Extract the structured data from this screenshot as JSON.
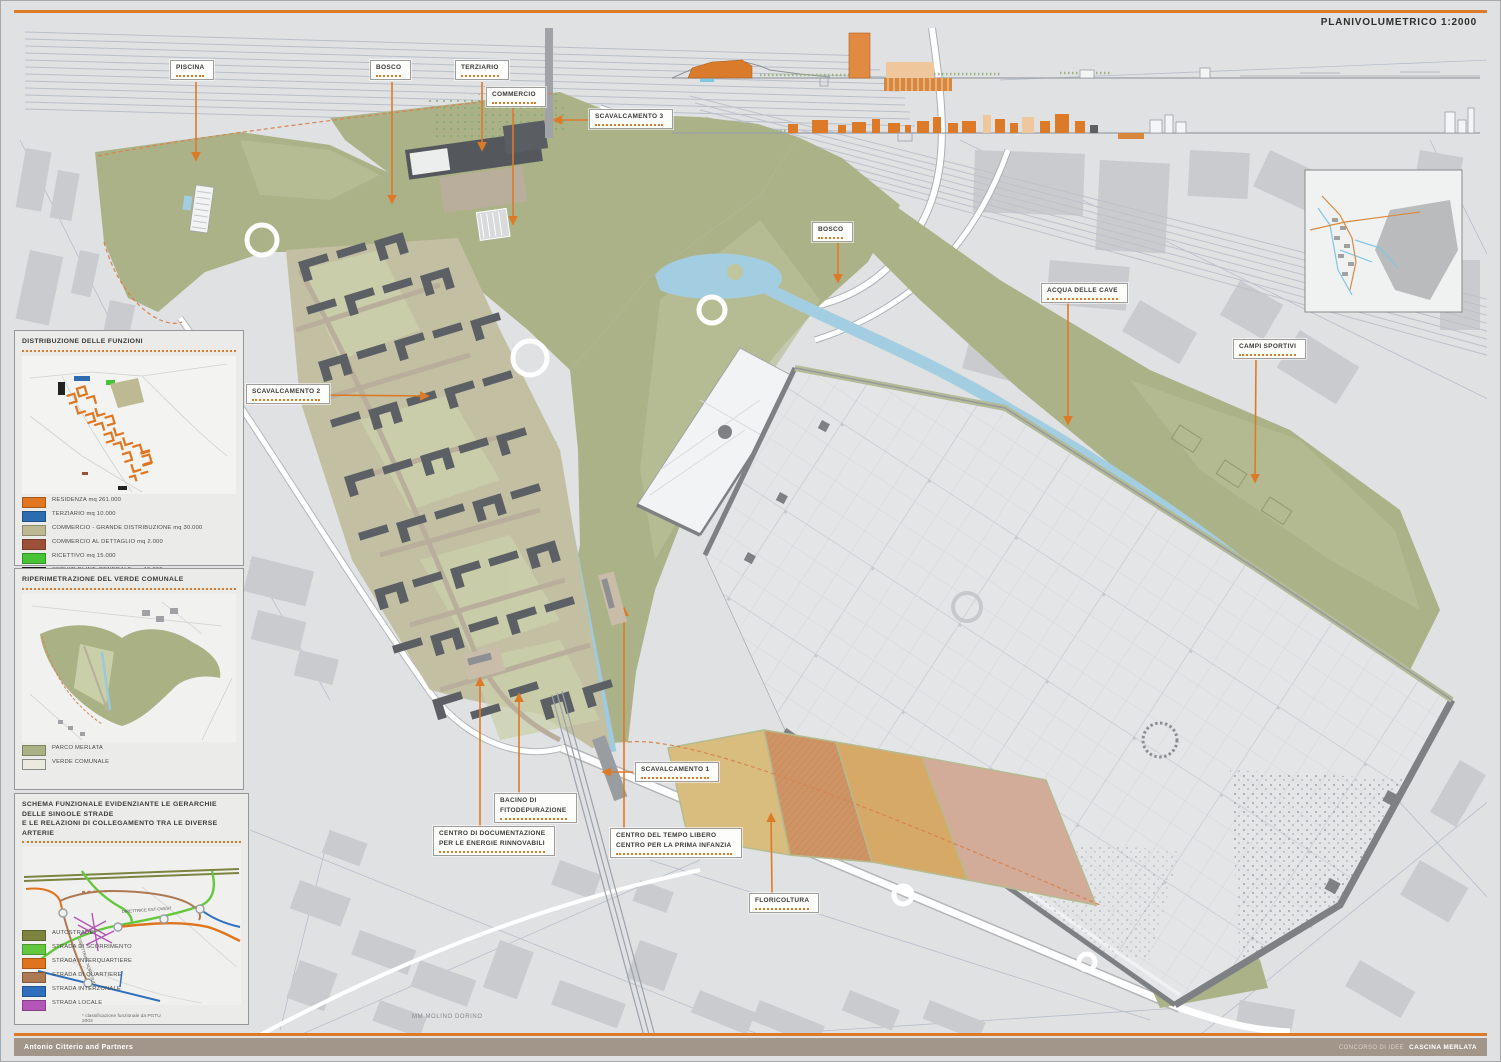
{
  "title": "PLANIVOLUMETRICO 1:2000",
  "accent_color": "#dd7a28",
  "map_labels": [
    {
      "id": "piscina",
      "lines": [
        "PISCINA"
      ]
    },
    {
      "id": "bosco-1",
      "lines": [
        "BOSCO"
      ]
    },
    {
      "id": "terziario",
      "lines": [
        "TERZIARIO"
      ]
    },
    {
      "id": "commercio",
      "lines": [
        "COMMERCIO"
      ]
    },
    {
      "id": "scavalcamento-3",
      "lines": [
        "SCAVALCAMENTO 3"
      ]
    },
    {
      "id": "bosco-2",
      "lines": [
        "BOSCO"
      ]
    },
    {
      "id": "acqua-delle-cave",
      "lines": [
        "ACQUA DELLE CAVE"
      ]
    },
    {
      "id": "campi-sportivi",
      "lines": [
        "CAMPI SPORTIVI"
      ]
    },
    {
      "id": "scavalcamento-2",
      "lines": [
        "SCAVALCAMENTO 2"
      ]
    },
    {
      "id": "scavalcamento-1",
      "lines": [
        "SCAVALCAMENTO 1"
      ]
    },
    {
      "id": "bacino",
      "lines": [
        "BACINO DI",
        "FITODEPURAZIONE"
      ]
    },
    {
      "id": "centro-doc",
      "lines": [
        "CENTRO DI DOCUMENTAZIONE",
        "PER LE ENERGIE RINNOVABILI"
      ]
    },
    {
      "id": "centro-tempo",
      "lines": [
        "CENTRO DEL TEMPO LIBERO",
        "CENTRO PER LA PRIMA INFANZIA"
      ]
    },
    {
      "id": "floricoltura",
      "lines": [
        "FLORICOLTURA"
      ]
    }
  ],
  "annotations": {
    "metro_station": "MM MOLINO DORINO"
  },
  "panels": {
    "funzioni": {
      "title": "DISTRIBUZIONE DELLE FUNZIONI",
      "legend": [
        {
          "label": "RESIDENZA mq 261.000",
          "color": "#e0761f"
        },
        {
          "label": "TERZIARIO mq 10.000",
          "color": "#2d6cb0"
        },
        {
          "label": "COMMERCIO - GRANDE DISTRIBUZIONE mq 30.000",
          "color": "#bcb993"
        },
        {
          "label": "COMMERCIO AL DETTAGLIO mq 2.000",
          "color": "#9d5038"
        },
        {
          "label": "RICETTIVO mq 15.000",
          "color": "#47c336"
        },
        {
          "label": "SERVIZI DI INT. GENERALE mq 15.000",
          "color": "#222220"
        }
      ]
    },
    "verde": {
      "title": "RIPERIMETRAZIONE DEL VERDE COMUNALE",
      "legend": [
        {
          "label": "PARCO MERLATA",
          "color": "#a9b185"
        },
        {
          "label": "VERDE COMUNALE",
          "color": "#eceadf"
        }
      ]
    },
    "schema": {
      "title_line1": "SCHEMA FUNZIONALE EVIDENZIANTE LE GERARCHIE DELLE SINGOLE STRADE",
      "title_line2": "E LE RELAZIONI DI COLLEGAMENTO TRA LE DIVERSE ARTERIE",
      "diagram_labels": {
        "est_ovest": "DIRETTRICE EST-OVEST",
        "nord_sud": "DIRETTRICE NORD-SUD"
      },
      "legend": [
        {
          "label": "AUTOSTRADE",
          "color": "#7d8440"
        },
        {
          "label": "STRADA DI SCORRIMENTO",
          "color": "#64c83f"
        },
        {
          "label": "STRADA INTERQUARTIERE",
          "color": "#e0731d"
        },
        {
          "label": "STRADA DI QUARTIERE",
          "color": "#ad7953"
        },
        {
          "label": "STRADA INTERZONALE",
          "color": "#2e6fbe"
        },
        {
          "label": "STRADA LOCALE",
          "color": "#b455b8"
        }
      ],
      "note": "* classificazione funzionale da PGTU 2003"
    }
  },
  "footer": {
    "left": "Antonio Citterio and Partners",
    "right_prefix": "CONCORSO DI IDEE",
    "right_title": "CASCINA MERLATA"
  }
}
